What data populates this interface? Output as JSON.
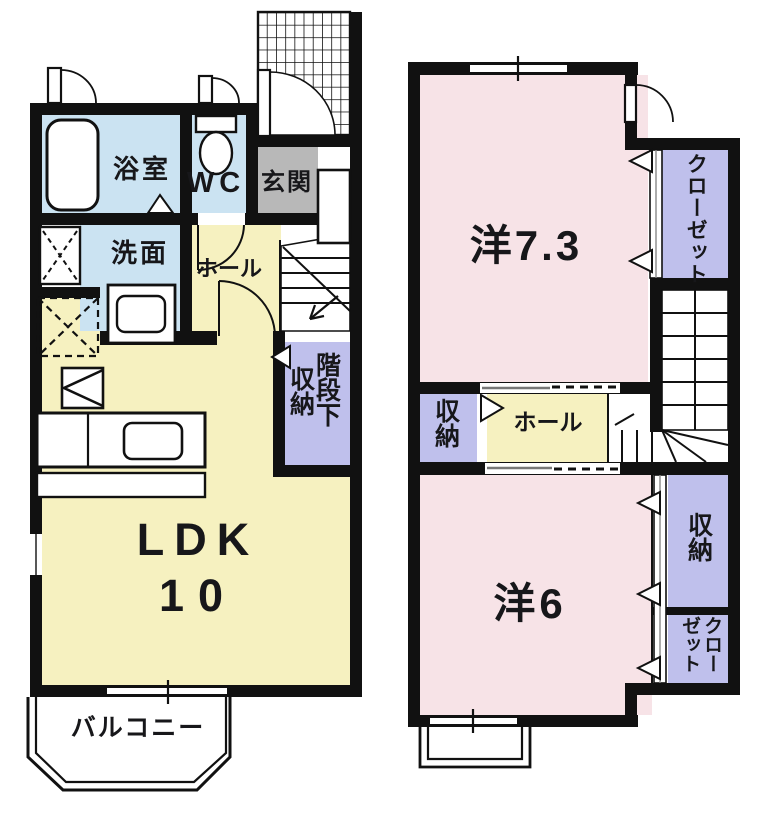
{
  "image_type": "japanese-apartment-floor-plan",
  "colors": {
    "wall": "#111111",
    "room_yellow": "#f6f1c0",
    "room_pink": "#f7e3e7",
    "room_blue": "#cbe3f2",
    "room_purple": "#bfc0ec",
    "entrance_gray": "#b8b8b8"
  },
  "floor1": {
    "bath": "浴室",
    "wc": "WC",
    "entrance": "玄関",
    "washroom": "洗面",
    "hall": "ホール",
    "under_stairs_storage_line1": "階段下",
    "under_stairs_storage_line2": "収納",
    "ldk": "LDK",
    "ldk_size": "10",
    "balcony": "バルコニー"
  },
  "floor2": {
    "western_room_7_3": "洋7.3",
    "closet_upper": "クローゼット",
    "storage_left": "収納",
    "hall": "ホール",
    "western_room_6": "洋6",
    "storage_right": "収納",
    "closet_lower_col_right": "クロー",
    "closet_lower_col_left": "ゼット"
  }
}
